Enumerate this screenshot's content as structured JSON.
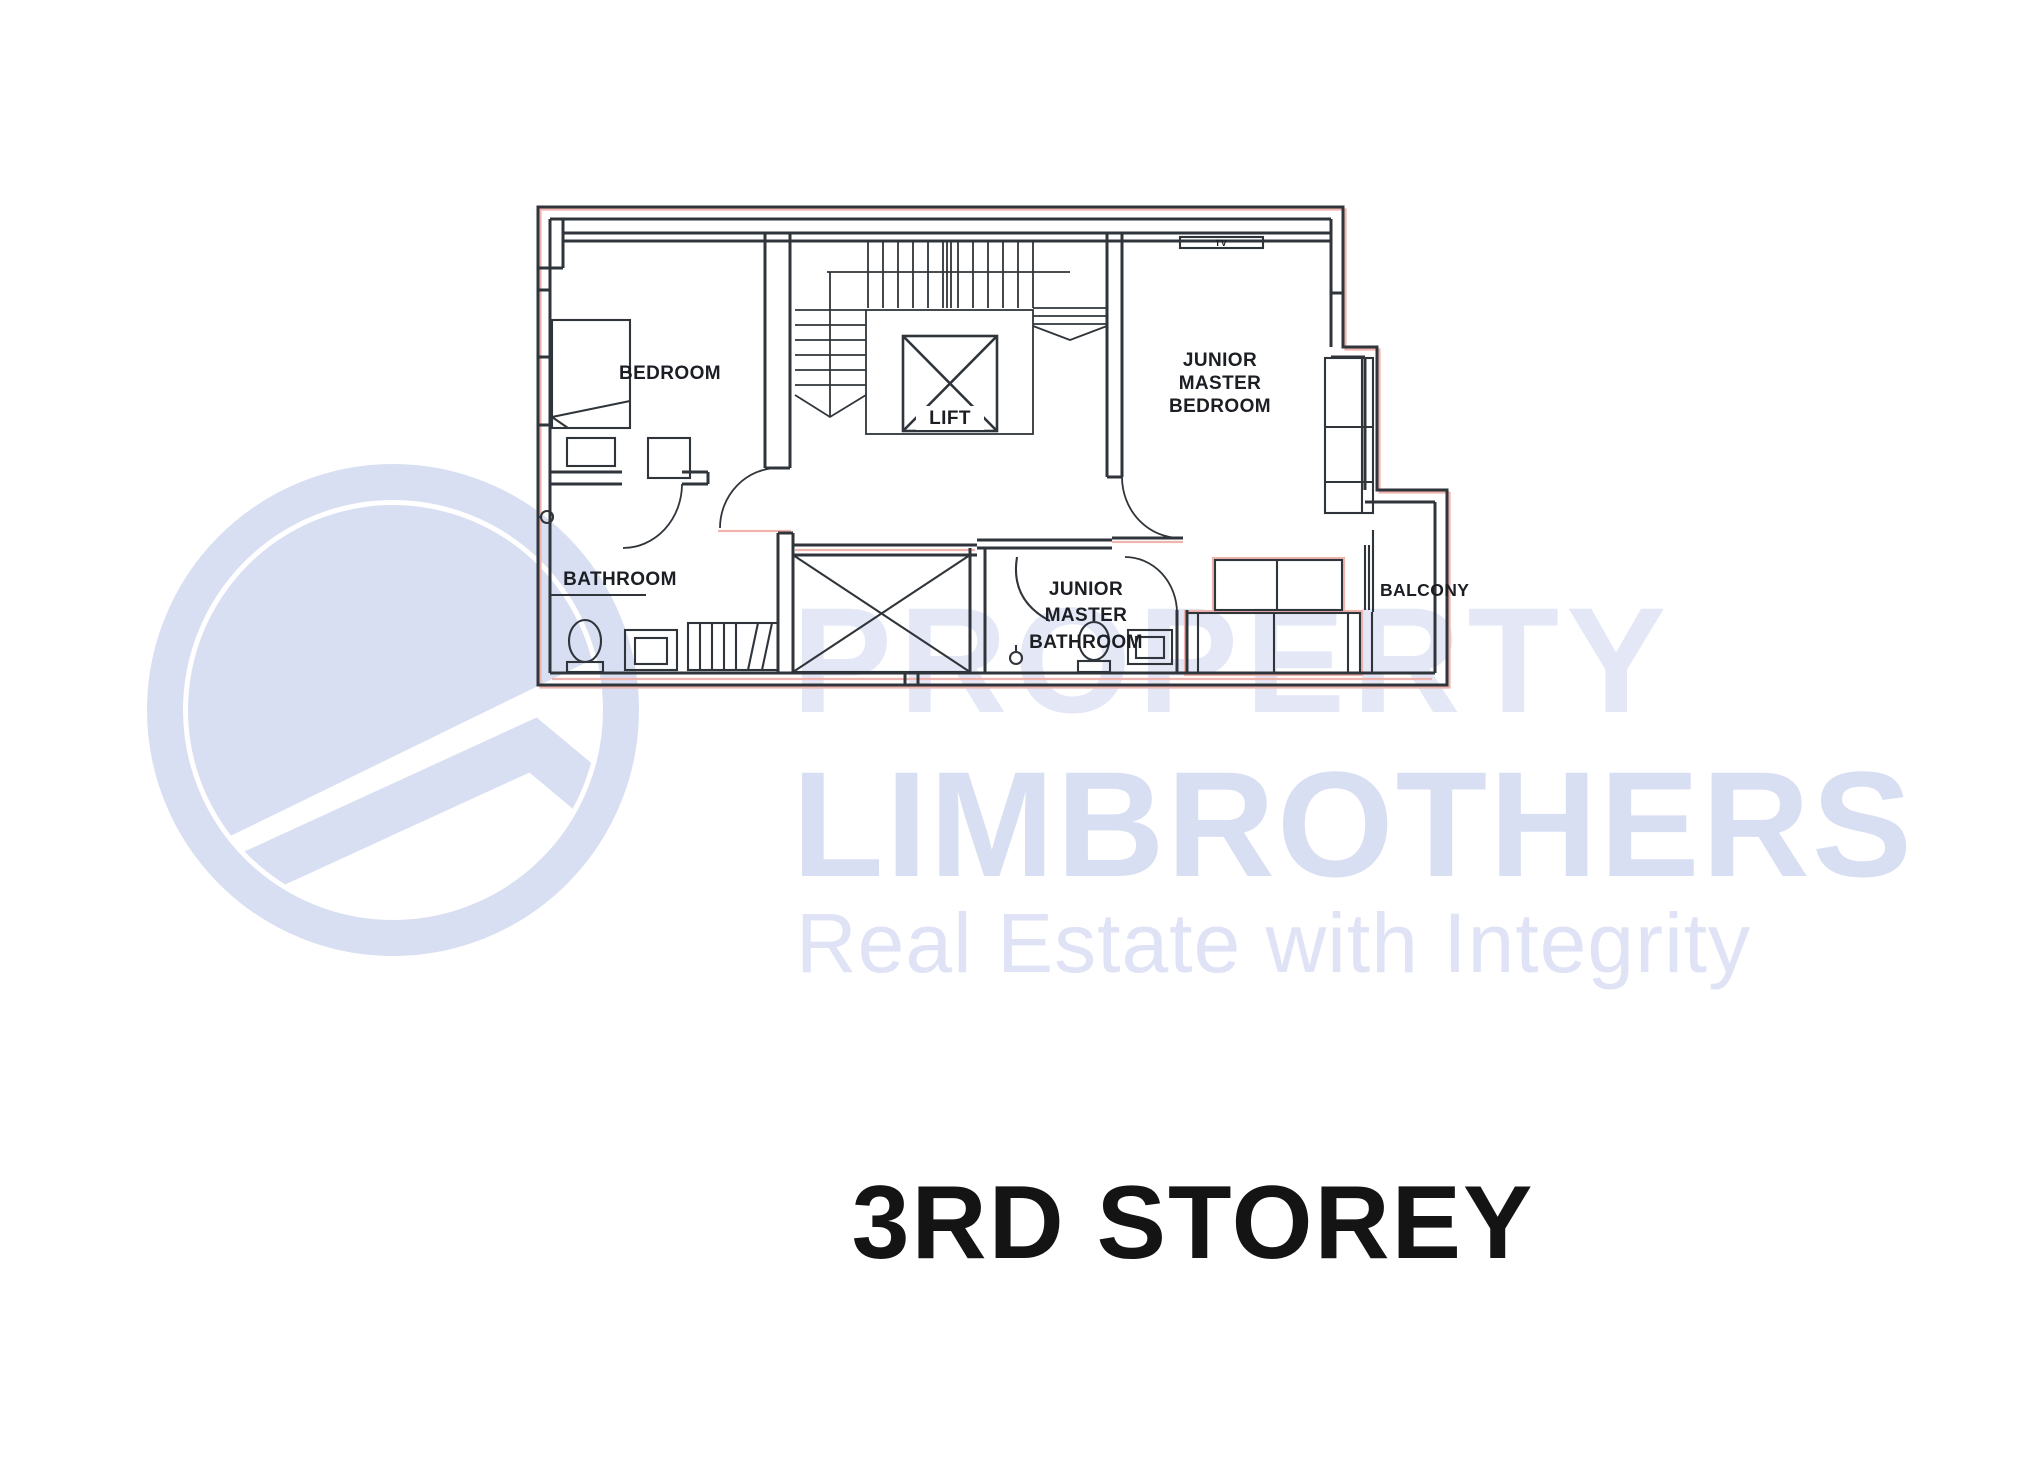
{
  "title": "3RD STOREY",
  "watermark": {
    "brand_top": "PROPERTY",
    "brand_main": "LIMBROTHERS",
    "tagline": "Real Estate with Integrity"
  },
  "colors": {
    "line": "#2f353a",
    "label": "#1b1e23",
    "pink": "#efb4ae",
    "watermark_fill": "#d9dff2",
    "watermark_light": "#e3e7f6",
    "watermark_tag": "#dfe3f5",
    "title_color": "#141414"
  },
  "floor_plan": {
    "rooms": {
      "bedroom": "BEDROOM",
      "lift": "LIFT",
      "bathroom": "BATHROOM",
      "balcony": "BALCONY",
      "junior_master_bedroom": [
        "JUNIOR",
        "MASTER",
        "BEDROOM"
      ],
      "junior_master_bathroom": [
        "JUNIOR",
        "MASTER",
        "BATHROOM"
      ],
      "tv": "TV"
    }
  }
}
